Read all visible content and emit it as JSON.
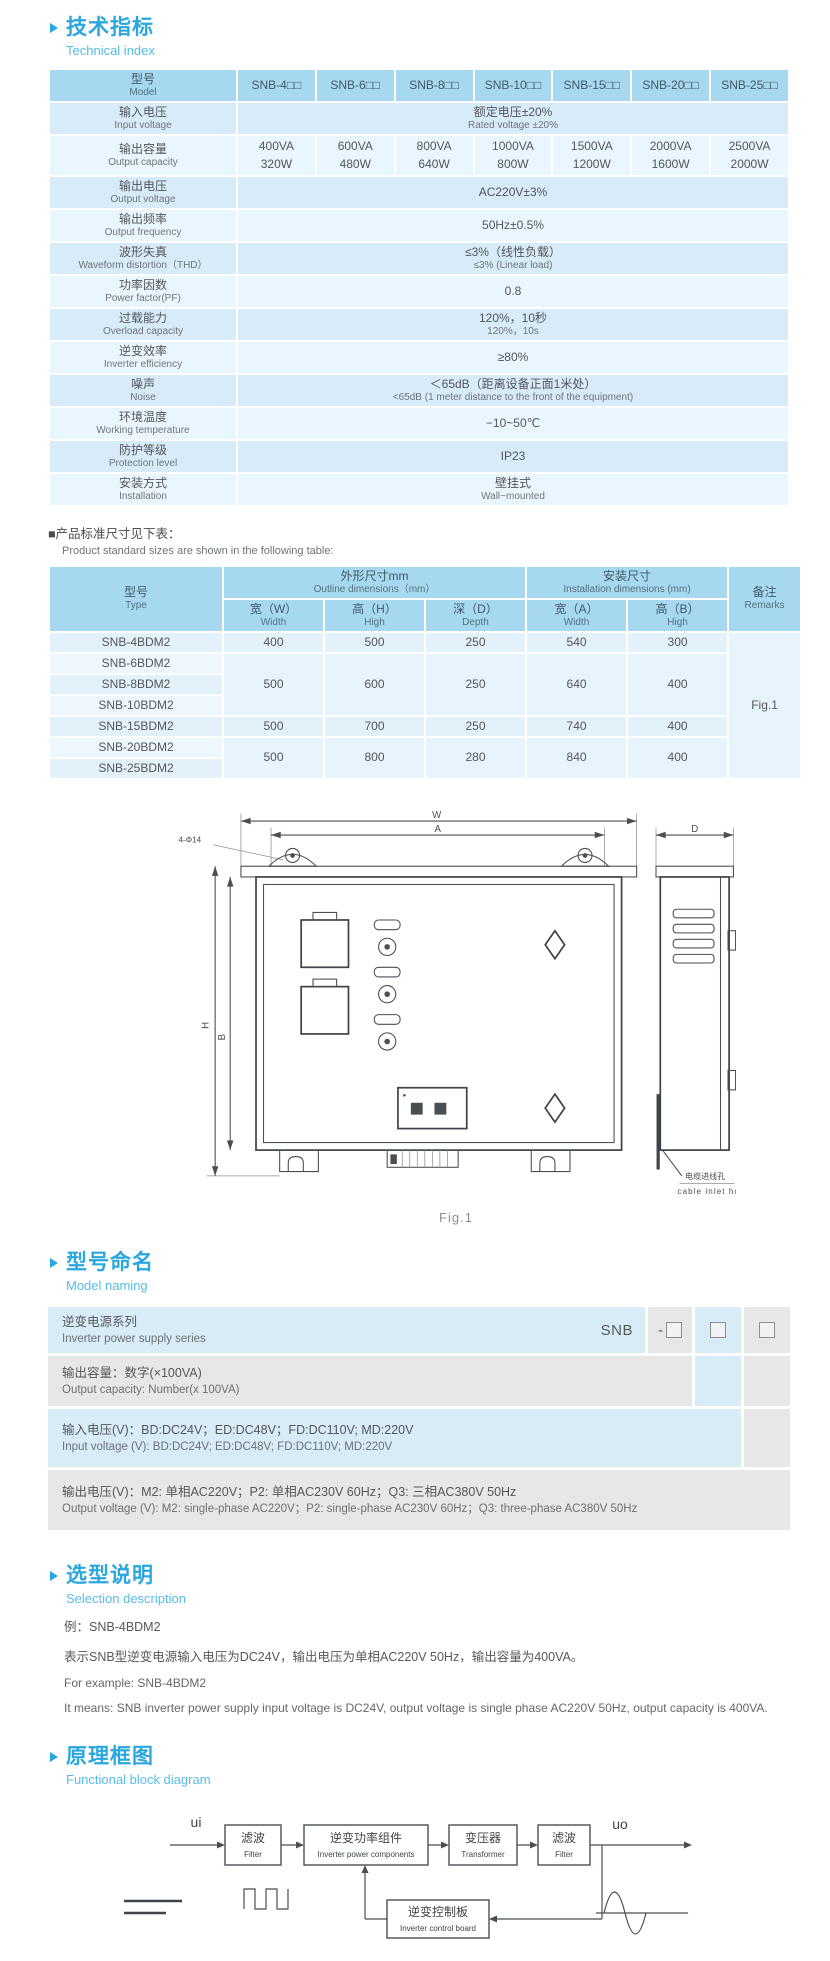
{
  "page": {
    "bg": "#ffffff",
    "accent": "#2aa7df",
    "table_header_bg": "#a6d8f0",
    "row_blue_dark": "#d7ebf8",
    "row_blue_light": "#eaf6fd"
  },
  "sections": {
    "technical": {
      "title_zh": "技术指标",
      "title_en": "Technical index"
    },
    "note": {
      "zh": "■产品标准尺寸见下表：",
      "en": "Product standard sizes are shown in the following table:"
    },
    "naming": {
      "title_zh": "型号命名",
      "title_en": "Model naming"
    },
    "selection": {
      "title_zh": "选型说明",
      "title_en": "Selection description"
    },
    "diagram": {
      "title_zh": "原理框图",
      "title_en": "Functional block diagram"
    }
  },
  "spec_table": {
    "header_zh": "型号",
    "header_en": "Model",
    "models": [
      "SNB-4□□",
      "SNB-6□□",
      "SNB-8□□",
      "SNB-10□□",
      "SNB-15□□",
      "SNB-20□□",
      "SNB-25□□"
    ],
    "rows": [
      {
        "zh": "输入电压",
        "en": "Input voltage",
        "value_lines": [
          "额定电压±20%",
          "Rated voltage ±20%"
        ]
      },
      {
        "zh": "输出容量",
        "en": "Output capacity",
        "values": [
          [
            "400VA",
            "320W"
          ],
          [
            "600VA",
            "480W"
          ],
          [
            "800VA",
            "640W"
          ],
          [
            "1000VA",
            "800W"
          ],
          [
            "1500VA",
            "1200W"
          ],
          [
            "2000VA",
            "1600W"
          ],
          [
            "2500VA",
            "2000W"
          ]
        ]
      },
      {
        "zh": "输出电压",
        "en": "Output voltage",
        "value_lines": [
          "AC220V±3%"
        ]
      },
      {
        "zh": "输出频率",
        "en": "Output frequency",
        "value_lines": [
          "50Hz±0.5%"
        ]
      },
      {
        "zh": "波形失真",
        "en": "Waveform distortion（THD）",
        "value_lines": [
          "≤3%（线性负载）",
          "≤3% (Linear load)"
        ]
      },
      {
        "zh": "功率因数",
        "en": "Power factor(PF)",
        "value_lines": [
          "0.8"
        ]
      },
      {
        "zh": "过载能力",
        "en": "Overload capacity",
        "value_lines": [
          "120%，10秒",
          "120%，10s"
        ]
      },
      {
        "zh": "逆变效率",
        "en": "Inverter efficiency",
        "value_lines": [
          "≥80%"
        ]
      },
      {
        "zh": "噪声",
        "en": "Noise",
        "value_lines": [
          "＜65dB（距离设备正面1米处）",
          "<65dB (1 meter distance to the front of the equipment)"
        ]
      },
      {
        "zh": "环境温度",
        "en": "Working temperature",
        "value_lines": [
          "−10~50℃"
        ]
      },
      {
        "zh": "防护等级",
        "en": "Protection level",
        "value_lines": [
          "IP23"
        ]
      },
      {
        "zh": "安装方式",
        "en": "Installation",
        "value_lines": [
          "壁挂式",
          "Wall−mounted"
        ]
      }
    ]
  },
  "dim_table": {
    "type_zh": "型号",
    "type_en": "Type",
    "outline_zh": "外形尺寸mm",
    "outline_en": "Outline dimensions（mm）",
    "install_zh": "安装尺寸",
    "install_en": "Installation dimensions (mm)",
    "remarks_zh": "备注",
    "remarks_en": "Remarks",
    "cols": [
      {
        "zh": "宽（W）",
        "en": "Width"
      },
      {
        "zh": "高（H）",
        "en": "High"
      },
      {
        "zh": "深（D）",
        "en": "Depth"
      },
      {
        "zh": "宽（A）",
        "en": "Width"
      },
      {
        "zh": "高（B）",
        "en": "High"
      }
    ],
    "remarks_value": "Fig.1",
    "rows": [
      {
        "type": "SNB-4BDM2",
        "dims": [
          "400",
          "500",
          "250",
          "540",
          "300"
        ],
        "span": 1
      },
      {
        "type": "SNB-6BDM2",
        "dims": [
          "500",
          "600",
          "250",
          "640",
          "400"
        ],
        "span": 3
      },
      {
        "type": "SNB-8BDM2"
      },
      {
        "type": "SNB-10BDM2"
      },
      {
        "type": "SNB-15BDM2",
        "dims": [
          "500",
          "700",
          "250",
          "740",
          "400"
        ],
        "span": 1
      },
      {
        "type": "SNB-20BDM2",
        "dims": [
          "500",
          "800",
          "280",
          "840",
          "400"
        ],
        "span": 2
      },
      {
        "type": "SNB-25BDM2"
      }
    ]
  },
  "figure": {
    "caption": "Fig.1",
    "labels": {
      "w": "W",
      "a": "A",
      "d": "D",
      "h": "H",
      "b": "B",
      "holes": "4-Φ14",
      "cable_zh": "电缆进线孔",
      "cable_en": "cable inlet hole"
    }
  },
  "naming": {
    "code": "SNB",
    "dash": "-",
    "rows": [
      {
        "zh": "逆变电源系列",
        "en": "Inverter power supply series"
      },
      {
        "zh": "输出容量：数字(×100VA)",
        "en": "Output capacity: Number(x 100VA)"
      },
      {
        "zh": "输入电压(V)：BD:DC24V；ED:DC48V；FD:DC110V; MD:220V",
        "en": "Input voltage (V): BD:DC24V; ED:DC48V; FD:DC110V; MD:220V"
      },
      {
        "zh": "输出电压(V)：M2: 单相AC220V；P2: 单相AC230V 60Hz；Q3: 三相AC380V 50Hz",
        "en": "Output voltage (V): M2: single-phase AC220V；P2: single-phase AC230V 60Hz；Q3: three-phase AC380V 50Hz"
      }
    ]
  },
  "selection": {
    "lines": [
      "例：SNB-4BDM2",
      "表示SNB型逆变电源输入电压为DC24V，输出电压为单相AC220V 50Hz，输出容量为400VA。",
      "For example: SNB-4BDM2",
      "It means: SNB inverter power supply input voltage is DC24V, output voltage is single phase AC220V 50Hz, output capacity is 400VA."
    ]
  },
  "diagram": {
    "in": "ui",
    "out": "uo",
    "boxes": [
      {
        "zh": "滤波",
        "en": "Filter"
      },
      {
        "zh": "逆变功率组件",
        "en": "Inverter power components"
      },
      {
        "zh": "变压器",
        "en": "Transformer"
      },
      {
        "zh": "滤波",
        "en": "Filter"
      },
      {
        "zh": "逆变控制板",
        "en": "Inverter control board"
      }
    ]
  }
}
